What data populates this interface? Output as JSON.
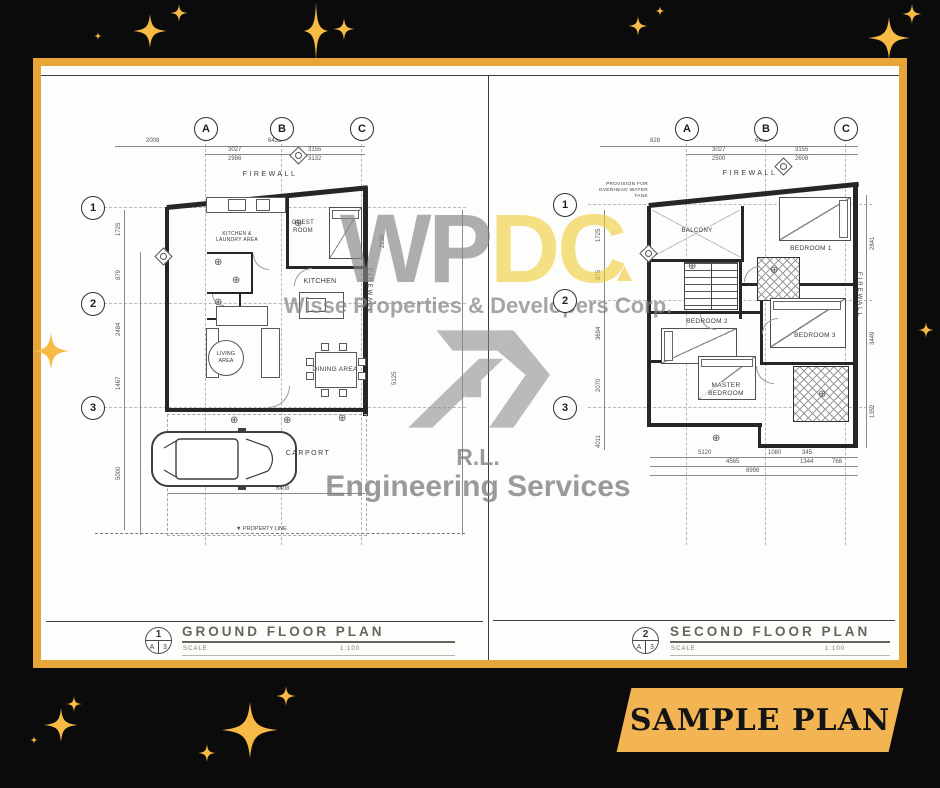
{
  "banner": {
    "label": "SAMPLE PLAN"
  },
  "colors": {
    "background": "#0B0B0C",
    "gold_frame": "#E7A437",
    "gold_banner": "#F3B553",
    "sparkle": "#F6BA45",
    "paper": "#FDFDFC",
    "ink": "#262626",
    "watermark_gray": "#868686",
    "watermark_yellow": "#EFCD38"
  },
  "icons": {
    "fixture": "⊕",
    "marker": "▼"
  },
  "watermark": {
    "brand_gray": "WP",
    "brand_yellow": "DC",
    "company": "Wisse Properties & Developers Corp.",
    "initials": "R.L.",
    "services": "Engineering Services"
  },
  "sheets": [
    {
      "number": "1",
      "ref_a": "A",
      "ref_b": "3",
      "title": "GROUND FLOOR PLAN",
      "scale_label": "SCALE",
      "scale_value": "1:100",
      "grid_columns": [
        "A",
        "B",
        "C"
      ],
      "grid_rows": [
        "1",
        "2",
        "3"
      ],
      "labels": {
        "firewall_top": "FIREWALL",
        "firewall_side": "FIREWALL",
        "guest_room": "GUEST ROOM",
        "kitchen": "KITCHEN",
        "laundry": "KITCHEN & LAUNDRY AREA",
        "living_area": "LIVING AREA",
        "dining_area": "DINING AREA",
        "carport": "CARPORT",
        "property_line": "PROPERTY LINE"
      },
      "dimensions": {
        "top": [
          "2008",
          "6432"
        ],
        "mid": [
          "3027",
          "3155"
        ],
        "sub": [
          "2986",
          "3132"
        ],
        "left": [
          "1725",
          "879",
          "2484",
          "1467",
          "5000"
        ],
        "right": [
          "2230",
          "5125"
        ],
        "bottom": [
          "6408"
        ]
      }
    },
    {
      "number": "2",
      "ref_a": "A",
      "ref_b": "3",
      "title": "SECOND FLOOR PLAN",
      "scale_label": "SCALE",
      "scale_value": "1:100",
      "grid_columns": [
        "A",
        "B",
        "C"
      ],
      "grid_rows": [
        "1",
        "2",
        "3"
      ],
      "labels": {
        "firewall_top": "FIREWALL",
        "firewall_side": "FIREWALL",
        "note": "PROVISION FOR OVERHEAD WATER TANK",
        "balcony": "BALCONY",
        "bedroom1": "BEDROOM 1",
        "bedroom2": "BEDROOM 2",
        "bedroom3": "BEDROOM 3",
        "master": "MASTER BEDROOM"
      },
      "dimensions": {
        "top": [
          "828",
          "6432"
        ],
        "mid": [
          "3027",
          "3155"
        ],
        "sub": [
          "2500",
          "2608"
        ],
        "left": [
          "1725",
          "875",
          "3694",
          "2070",
          "4011"
        ],
        "right": [
          "2841",
          "3449",
          "1352"
        ],
        "bottom": [
          "5120",
          "1080",
          "345"
        ],
        "bottom_sub": [
          "4565",
          "1344",
          "768"
        ],
        "bottom_total": [
          "8998"
        ]
      }
    }
  ]
}
